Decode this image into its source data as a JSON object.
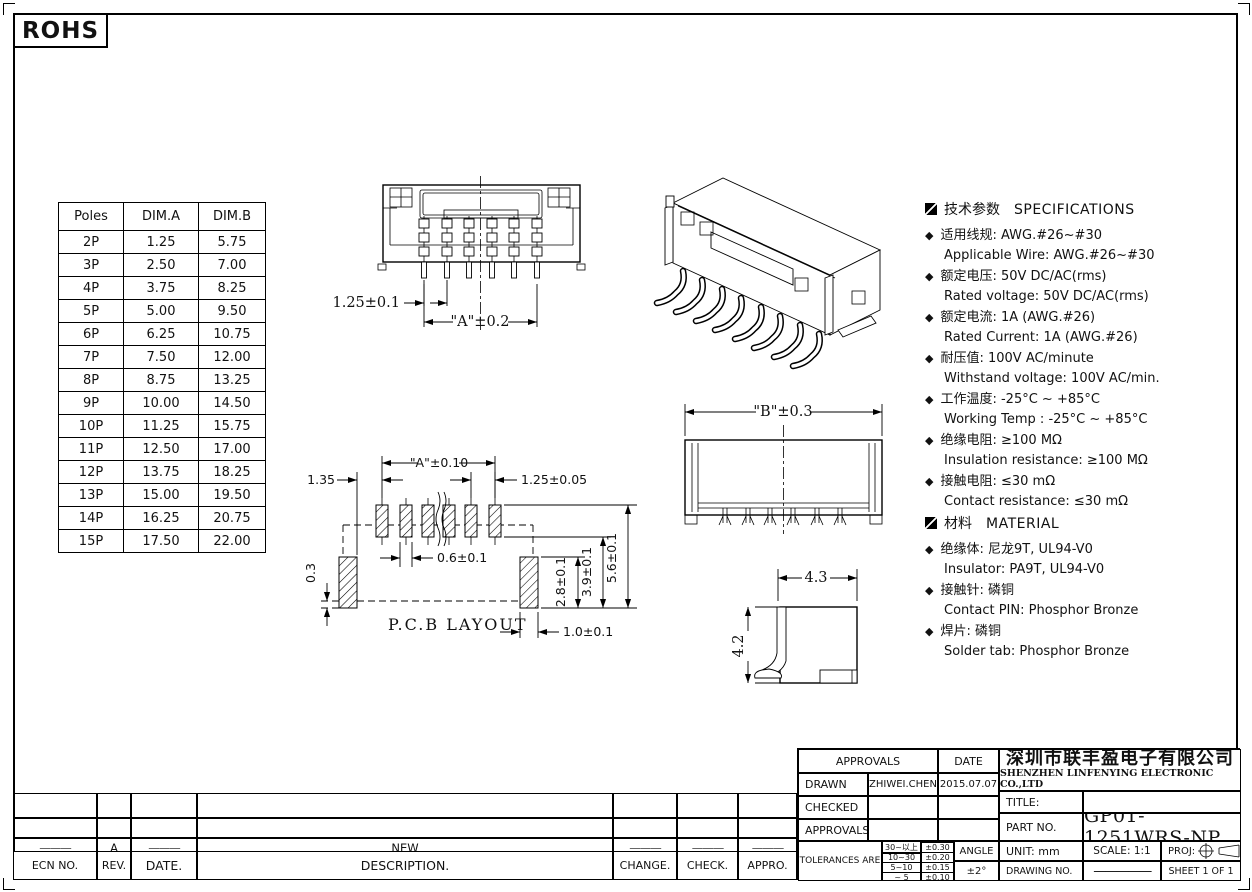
{
  "rohs_label": "ROHS",
  "poles_table": {
    "headers": [
      "Poles",
      "DIM.A",
      "DIM.B"
    ],
    "rows": [
      [
        "2P",
        "1.25",
        "5.75"
      ],
      [
        "3P",
        "2.50",
        "7.00"
      ],
      [
        "4P",
        "3.75",
        "8.25"
      ],
      [
        "5P",
        "5.00",
        "9.50"
      ],
      [
        "6P",
        "6.25",
        "10.75"
      ],
      [
        "7P",
        "7.50",
        "12.00"
      ],
      [
        "8P",
        "8.75",
        "13.25"
      ],
      [
        "9P",
        "10.00",
        "14.50"
      ],
      [
        "10P",
        "11.25",
        "15.75"
      ],
      [
        "11P",
        "12.50",
        "17.00"
      ],
      [
        "12P",
        "13.75",
        "18.25"
      ],
      [
        "13P",
        "15.00",
        "19.50"
      ],
      [
        "14P",
        "16.25",
        "20.75"
      ],
      [
        "15P",
        "17.50",
        "22.00"
      ]
    ]
  },
  "drawings": {
    "front_view": {
      "pitch": "1.25±0.1",
      "dim_a": "\"A\"±0.2"
    },
    "side_view": {
      "dim_b": "\"B\"±0.3"
    },
    "pcb_layout": {
      "title": "P.C.B LAYOUT",
      "dim_a": "\"A\"±0.10",
      "left_offset": "1.35",
      "pad_pitch": "1.25±0.05",
      "pad_width": "0.6±0.1",
      "tab_offset": "0.3",
      "tab_height": "2.8±0.1",
      "row_span": "3.9±0.1",
      "total_span": "5.6±0.1",
      "tab_width": "1.0±0.1"
    },
    "profile_view": {
      "width": "4.3",
      "height": "4.2"
    }
  },
  "specifications": {
    "section_zh": "技术参数",
    "section_en": "SPECIFICATIONS",
    "items": [
      {
        "zh": "适用线规:  AWG.#26~#30",
        "en": "Applicable Wire:  AWG.#26~#30"
      },
      {
        "zh": "额定电压:  50V DC/AC(rms)",
        "en": "Rated voltage:  50V DC/AC(rms)"
      },
      {
        "zh": "额定电流:  1A (AWG.#26)",
        "en": "Rated Current: 1A (AWG.#26)"
      },
      {
        "zh": "耐压值:  100V AC/minute",
        "en": "Withstand voltage: 100V AC/min."
      },
      {
        "zh": "工作温度:  -25°C ~ +85°C",
        "en": "Working Temp : -25°C ~ +85°C"
      },
      {
        "zh": "绝缘电阻:   ≥100 MΩ",
        "en": "Insulation resistance:  ≥100 MΩ"
      },
      {
        "zh": "接触电阻:  ≤30 mΩ",
        "en": "Contact resistance:  ≤30 mΩ"
      }
    ],
    "material_zh": "材料",
    "material_en": "MATERIAL",
    "material_items": [
      {
        "zh": "绝缘体:  尼龙9T, UL94-V0",
        "en": "Insulator: PA9T, UL94-V0"
      },
      {
        "zh": "接触针:  磷铜",
        "en": "Contact PIN: Phosphor Bronze"
      },
      {
        "zh": "焊片:  磷铜",
        "en": "Solder tab: Phosphor Bronze"
      }
    ]
  },
  "revision_table": {
    "headers": [
      "ECN NO.",
      "REV.",
      "DATE.",
      "DESCRIPTION.",
      "CHANGE.",
      "CHECK.",
      "APPRO."
    ],
    "rows": [
      [
        "",
        "",
        "",
        "",
        "",
        "",
        ""
      ],
      [
        "",
        "",
        "",
        "",
        "",
        "",
        ""
      ],
      [
        "———",
        "A",
        "———",
        "NEW",
        "———",
        "———",
        "———"
      ]
    ]
  },
  "title_block": {
    "approvals_label": "APPROVALS",
    "date_label": "DATE",
    "drawn_label": "DRAWN",
    "drawn_value": "ZHIWEI.CHEN",
    "drawn_date": "2015.07.07",
    "checked_label": "CHECKED",
    "approved_label": "APPROVALS",
    "tolerances_label": "TOLERANCES  ARE",
    "tolerance_rows": [
      [
        "30~以上",
        "±0.30"
      ],
      [
        "10~30",
        "±0.20"
      ],
      [
        "5~10",
        "±0.15"
      ],
      [
        "~ 5",
        "±0.10"
      ]
    ],
    "angle_label": "ANGLE",
    "angle_value": "±2°",
    "company_zh": "深圳市联丰盈电子有限公司",
    "company_en": "SHENZHEN LINFENYING ELECTRONIC CO.,LTD",
    "title_label": "TITLE:",
    "part_no_label": "PART  NO.",
    "part_no_value": "GP01-1251WRS-NP",
    "unit_label": "UNIT:  mm",
    "scale_label": "SCALE:   1:1",
    "proj_label": "PROJ:",
    "drawing_no_label": "DRAWING  NO.",
    "drawing_no_value": "—————",
    "sheet_label": "SHEET   1  OF  1"
  }
}
